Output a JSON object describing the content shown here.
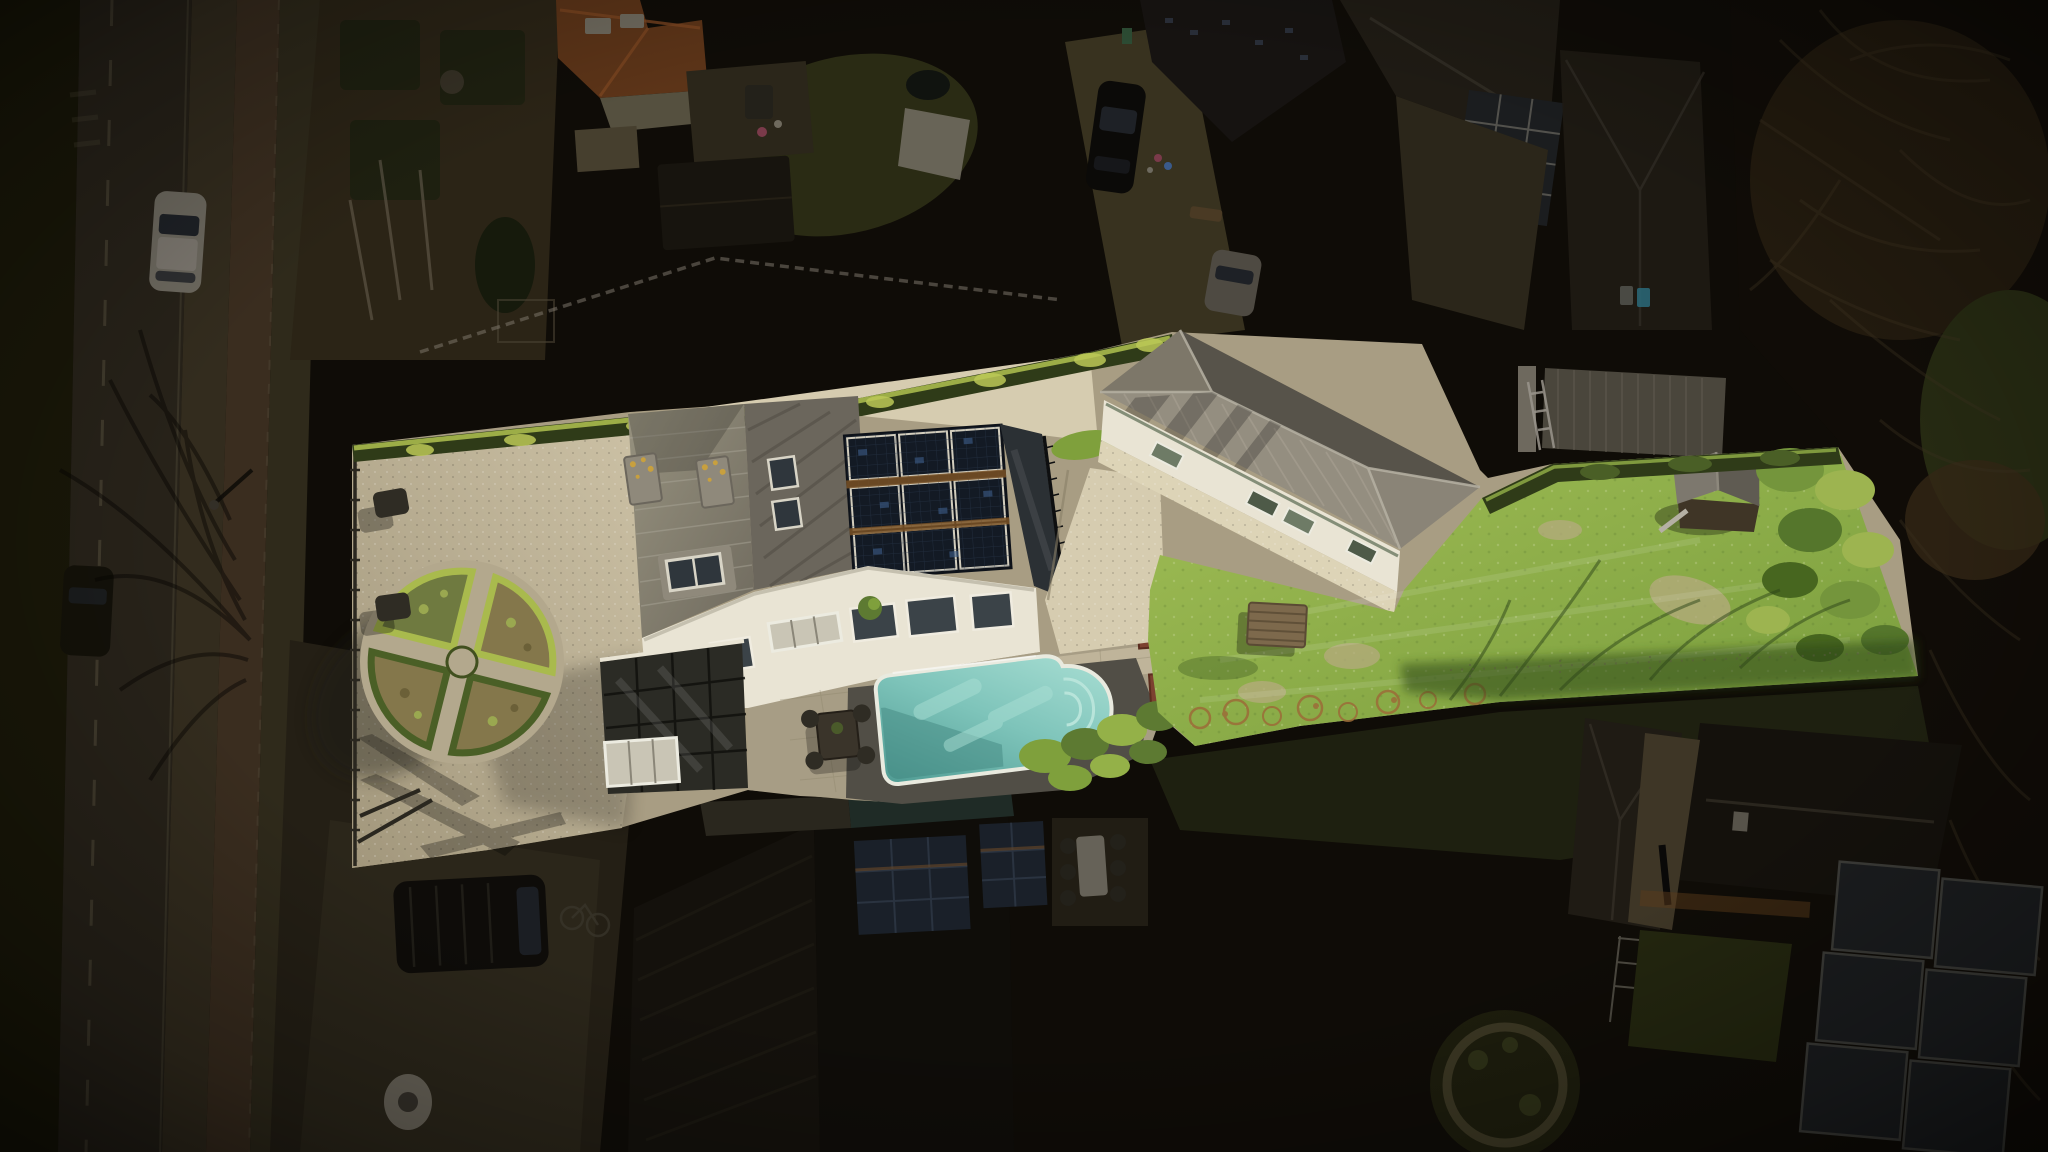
{
  "image": {
    "kind": "aerial-drone-photograph",
    "description": "Top-down drone photo of a long narrow residential property shown brightly sunlit while all surrounding houses, road and woods are darkened (real-estate highlight vignette).",
    "width_px": 2048,
    "height_px": 1152,
    "visible_text": []
  },
  "scene": {
    "highlighted_property": [
      "gravel courtyard with circular boxwood parterre garden of four quadrant beds",
      "perimeter metal fence and gates on street side with two garden chairs",
      "main house with grey tiled multi-plane roof, dormer window, two lichen-spotted chimneys, roof skylights",
      "solar panel array of nine dark panels with rust-colored separator bars on rear roof plane",
      "dark flat roof terrace with black railing",
      "white facade with window row and glazed veranda with white rooflight",
      "stone paved patio with dark outdoor dining set and potted plant",
      "turquoise swimming pool with rounded roman end, white rim and entry steps",
      "white gravel side path with brick planter posts and green shrubs",
      "white bungalow with large grey hip roof, green-framed skylights and gravel apron",
      "long green lawn with wooden bench, grey-roofed playhouse, bare orange shrubs, shrub mounds, boundary hedges and tree shadows"
    ],
    "dark_surroundings": [
      "street with lane markings, sidewalk, cycle path, parked white car and dark car, bare tree shadows",
      "top-left neighbor gardens with soil beds, birch trunks, conifer, picket fences and orange tiled roof house",
      "top-center neighbor backyard with lawn, shade sail, shed, pond and colorful patio items",
      "neighbor driveway with black car, silver car, dark roofed outbuildings and laundry",
      "corrugated-roof shed with white ladder and waste bins near the lawn boundary",
      "dense dark woods with bare branches along the right edge",
      "bottom foreground: dark gabled house with rooftop solar panels and teal-edged flat roof",
      "shadowed patio dining set, driveway with dark van and bicycle, white garden table",
      "bottom-right neighbor roofs, glass conservatory panels, rotary clothes dryer and round hedge garden"
    ],
    "lighting": "sun from upper right, shadows cast to lower left",
    "no_ui_elements": true
  },
  "colors": {
    "bg0": "#0f0c07",
    "verge": "#191708",
    "road": "#272219",
    "roadLine": "#5a5340",
    "sidewalk": "#332c1e",
    "cycle": "#3a2d1f",
    "sidewalk2": "#2f2a1b",
    "carWhiteDim": "#6e6a60",
    "carGlassDim": "#1e2126",
    "carDark": "#131109",
    "treeShadow": "#060503",
    "plotSoil": "#2b2416",
    "hedgeDim": "#1e2010",
    "conifer": "#161a0c",
    "trunkDim": "#6a6152",
    "fenceDim": "#7b7569",
    "orangeRoof": "#5c3418",
    "orangeRoofRidge": "#7a4520",
    "wallDim": "#55503f",
    "pathDim": "#463f2e",
    "lawnDim": "#2a2b14",
    "canopyDim": "#6f6a5e",
    "shedDim": "#17140e",
    "pondDim": "#10130f",
    "accentPink": "#7a3a4a",
    "accentBlue": "#3a5a8a",
    "driveDim": "#38321f",
    "carBlack": "#0b0a08",
    "roofDim1": "#161311",
    "roofDim2": "#1f1b14",
    "roofDimBig": "#14110c",
    "glassDim": "#1b1d1f",
    "frameDim": "#8a857a",
    "ladderDim": "#9a958c",
    "shedRoofDim": "#4a463c",
    "binTeal": "#2a6a7a",
    "woodsBase": "#100c07",
    "branch": "#3a2f1d",
    "foliage1": "#221a0e",
    "foliage2": "#262a12",
    "foliage3": "#332715",
    "paveDim": "#241f15",
    "paveDim2": "#2b261a",
    "vanDark": "#0e0c09",
    "vanGlass": "#1b1e23",
    "bikeDim": "#3a362c",
    "tableDim": "#6e6a5f",
    "chairDim": "#23211a",
    "tealRoofDim": "#1f2b26",
    "solarDim": "#1a2029",
    "solarFrameDim": "#2a3340",
    "rustDim": "#6a4a28",
    "stripeDim": "#1d1a13",
    "greenRingDim": "#3b3723",
    "lawnDim2": "#23260f",
    "orangeShrubDim": "#5a3a1a",
    "litBase": "#a89d83",
    "gravel1": "#cdc2a6",
    "gravel2": "#a2977c",
    "gravelPath": "#d6ccb0",
    "gravelApron": "#ddd4b7",
    "gravelShadow": "#6e6656",
    "hedgeTop": "#a9ba4d",
    "hedgeBright": "#bcc957",
    "hedgeDark": "#2f3b18",
    "hedgeMid": "#4a5f26",
    "bushGreen": "#5d7a32",
    "bushLight": "#7fa03c",
    "bushYellow": "#94b148",
    "bedStraw": "#84774b",
    "bedGreen": "#6f7a40",
    "bedDot": "#9aa850",
    "bedDot2": "#6b6038",
    "fenceMetal": "#2a271f",
    "chairMetal": "#2f2c24",
    "roofA1": "#97927f",
    "roofA2": "#6f6a5e",
    "roofB": "#6b665c",
    "roofRib": "#a8a396",
    "roofDiag": "#57534a",
    "chimney": "#8f897b",
    "lichen": "#c8a03e",
    "skylight": "#2f363c",
    "frameWhite": "#d8d4c6",
    "solarCell": "#131a24",
    "solarLine": "#2b3a50",
    "solarGlint": "#3d5e8a",
    "solarGap": "#d2cdbd",
    "rustBar": "#7a5226",
    "terrace": "#2b3034",
    "railing": "#0e0f10",
    "wallWhite": "#e9e4d4",
    "wallShade": "#b5b0a0",
    "winGlass": "#3b4348",
    "winFrame": "#f0ece0",
    "verandaGlass": "#2b2b25",
    "verandaFrame": "#11110d",
    "rooflightPane": "#c9c5b5",
    "rooflightFrame": "#ecebe0",
    "paver": "#a79d85",
    "paverLight": "#c3b99e",
    "paverLine": "#8a8068",
    "deckDark": "#514e46",
    "tableDark": "#3a342a",
    "potPlant": "#4a5a2a",
    "poolLight": "#aadfd4",
    "poolMid": "#7ec4ba",
    "poolDeep": "#4f9b93",
    "poolShade": "#3f827c",
    "poolRim": "#e9eadf",
    "poolStep": "#b8e4da",
    "brick": "#7c4130",
    "brickDark": "#5a2c1e",
    "bunFront": "#948e80",
    "bunLeft": "#7d7769",
    "bunRight": "#8a8477",
    "bunBack": "#57534a",
    "bunRib": "#a9a394",
    "bunLine": "#b5b0a2",
    "greenEdge": "#5a6a52",
    "skyGreen": "#6e7b66",
    "skyGreenDark": "#4e5a48",
    "lawn1": "#a0bd55",
    "lawn2": "#789c3c",
    "lawnWorn": "#b5ab7e",
    "lawnShadow": "#2c4417",
    "daisy": "#e8eec8",
    "benchWood": "#7d694c",
    "benchSlat": "#5a4a34",
    "playRoofL": "#7d786e",
    "playRoofR": "#5f5b52",
    "playWall": "#3f3526",
    "playSlide": "#b5b0a4",
    "shrubOrange": "#9c6c38",
    "mound1": "#9db450",
    "mound2": "#74953c",
    "mound3": "#55762c",
    "mound4": "#47661f",
    "fenceLawn": "#5a5a40"
  }
}
